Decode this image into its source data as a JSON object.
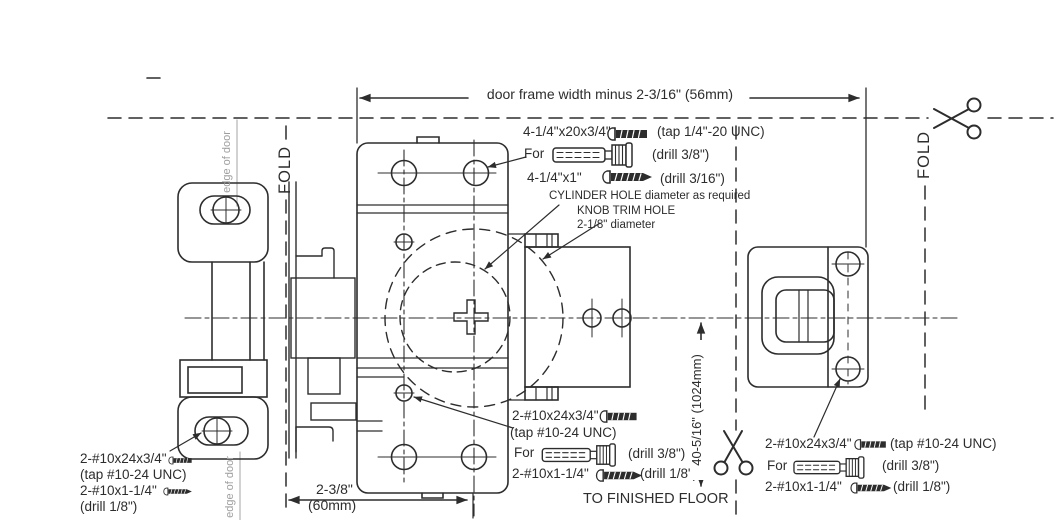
{
  "labels": {
    "door_frame_dim": "door frame width minus 2-3/16\" (56mm)",
    "fold": "FOLD",
    "edge_of_door": "edge of door",
    "cylinder_hole": "CYLINDER HOLE diameter as required",
    "knob_trim_hole": "KNOB TRIM HOLE",
    "knob_trim_diameter": "2-1/8\" diameter",
    "backset_in": "2-3/8\"",
    "backset_mm": "(60mm)",
    "floor_dim": "40-5/16\" (1024mm)",
    "to_finished_floor": "TO FINISHED FLOOR"
  },
  "fasteners": {
    "top": {
      "machine_qty": "4-1/4\"x20x3/4\"",
      "machine_note": "(tap 1/4\"-20 UNC)",
      "for_word": "For",
      "anchor_note": "(drill 3/8\")",
      "wood_qty": "4-1/4\"x1\"",
      "wood_note": "(drill 3/16\")"
    },
    "center": {
      "machine_qty": "2-#10x24x3/4\"",
      "machine_note": "(tap #10-24 UNC)",
      "for_word": "For",
      "anchor_note": "(drill 3/8\")",
      "wood_qty": "2-#10x1-1/4\"",
      "wood_note": "(drill 1/8\")"
    },
    "right": {
      "machine_qty": "2-#10x24x3/4\"",
      "machine_note": "(tap #10-24 UNC)",
      "for_word": "For",
      "anchor_note": "(drill 3/8\")",
      "wood_qty": "2-#10x1-1/4\"",
      "wood_note": "(drill 1/8\")"
    },
    "left": {
      "machine_qty": "2-#10x24x3/4\"",
      "machine_note": "(tap #10-24 UNC)",
      "wood_qty": "2-#10x1-1/4\"",
      "wood_note": "(drill 1/8\")"
    }
  },
  "colors": {
    "line": "#2d2d2d",
    "muted": "#9e9e9e"
  }
}
